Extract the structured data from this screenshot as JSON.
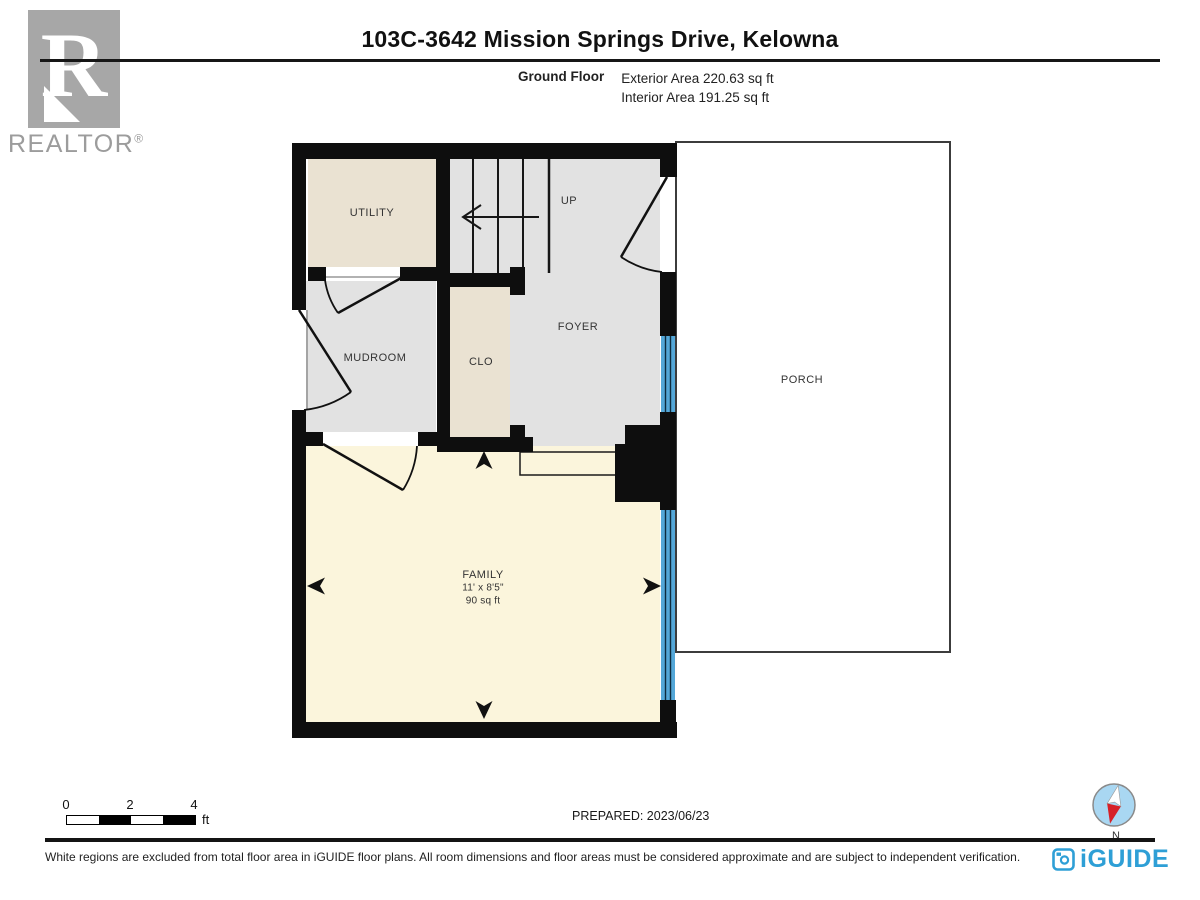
{
  "header": {
    "title": "103C-3642 Mission Springs Drive, Kelowna",
    "floor_label": "Ground Floor",
    "exterior_area": "Exterior Area 220.63 sq ft",
    "interior_area": "Interior Area 191.25 sq ft"
  },
  "branding": {
    "realtor_letter": "R",
    "realtor_word": "REALTOR",
    "realtor_reg": "®",
    "iguide_word": "iGUIDE"
  },
  "rooms": {
    "utility": "UTILITY",
    "up": "UP",
    "foyer": "FOYER",
    "mudroom": "MUDROOM",
    "clo": "CLO",
    "porch": "PORCH",
    "family_name": "FAMILY",
    "family_dims": "11' x 8'5\"",
    "family_area": "90 sq ft"
  },
  "scale_bar": {
    "tick0": "0",
    "tick2": "2",
    "tick4": "4",
    "unit": "ft"
  },
  "footer": {
    "prepared": "PREPARED: 2023/06/23",
    "compass_n": "N",
    "disclaimer": "White regions are excluded from total floor area in iGUIDE floor plans. All room dimensions and floor areas must be considered approximate and are subject to independent verification."
  },
  "colors": {
    "wall": "#0e0e0e",
    "room_gray": "#e2e2e2",
    "room_beige": "#eae2d2",
    "room_yellow": "#fbf5dc",
    "window_blue": "#54a7d8",
    "porch_white": "#ffffff",
    "iguide_blue": "#2e9fd6",
    "realtor_gray": "#a7a7a7",
    "compass_fill": "#a9d7f2",
    "compass_red": "#d62128"
  }
}
